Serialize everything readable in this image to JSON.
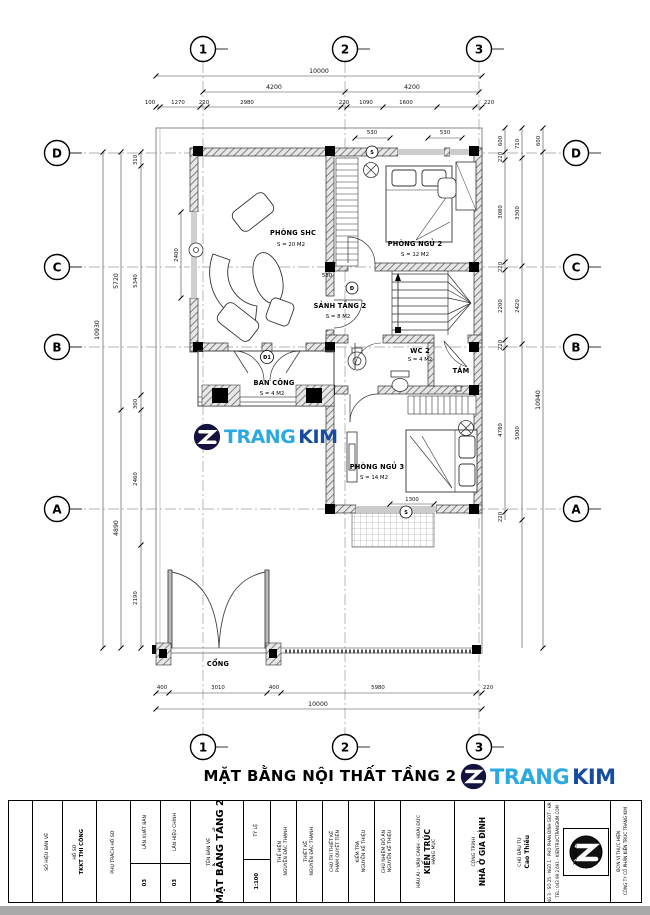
{
  "sheet": {
    "title": "MẶT BẰNG NỘI THẤT TẦNG 2"
  },
  "brand": {
    "trang": "TRANG",
    "kim": "KIM",
    "color_trang": "#2BA9E0",
    "color_kim": "#164BA0"
  },
  "grid": {
    "c1": "1",
    "c2": "2",
    "c3": "3",
    "rD": "D",
    "rC": "C",
    "rB": "B",
    "rA": "A"
  },
  "dims": {
    "t_overall": "10000",
    "t_span1": "4200",
    "t_span2": "4200",
    "t_d": [
      "100",
      "1270",
      "220",
      "2980",
      "220",
      "1090",
      "1600",
      "220"
    ],
    "t_small1": "530",
    "t_small2": "530",
    "b_d": [
      "400",
      "3010",
      "400",
      "5980",
      "220"
    ],
    "b_overall": "10000",
    "l_overall": "10930",
    "l_span1": "5720",
    "l_span2": "4890",
    "l_d": [
      "310",
      "5340",
      "300",
      "2460",
      "2190"
    ],
    "l_win": "2400",
    "r_d": [
      "600",
      "220",
      "3080",
      "220",
      "2200",
      "220",
      "4780",
      "220"
    ],
    "r_s": [
      "710",
      "3300",
      "2420",
      "5000"
    ],
    "r_top": "600",
    "r_overall": "10940",
    "i_door": "530",
    "i_bed": "1300"
  },
  "rooms": {
    "shc_name": "PHÒNG SHC",
    "shc_area": "S = 20 M2",
    "ngu2_name": "PHÒNG NGỦ 2",
    "ngu2_area": "S = 12 M2",
    "sanh_name": "SẢNH TẦNG 2",
    "sanh_area": "S = 8 M2",
    "wc2_name": "WC 2",
    "wc2_area": "S = 4 M2",
    "tam": "TẮM",
    "ngu3_name": "PHÒNG NGỦ 3",
    "ngu3_area": "S = 14 M2",
    "bc_name": "BAN CÔNG",
    "bc_area": "S = 4 M2",
    "cong": "CỔNG"
  },
  "tags": {
    "d1": "Đ1",
    "d": "Đ",
    "s1": "S",
    "s2": "S"
  },
  "titleblock": {
    "so_hieu_label": "SỐ HIỆU BẢN VẼ",
    "ho_so_label": "HỒ SƠ",
    "ho_so": "TKKT THI CÔNG",
    "phu_trach_label": "PHỤ TRÁCH HỒ SƠ",
    "lxb_label": "LẦN XUẤT BẢN",
    "lxb": "03",
    "lhc_label": "LẦN HIỆU CHỈNH",
    "lhc": "03",
    "tbv_label": "TÊN BẢN VẼ",
    "tbv": "MẶT BẰNG TẦNG 2",
    "tyle_label": "TỶ LỆ",
    "tyle": "1:100",
    "r1_label": "THỂ HIỆN",
    "r1": "NGUYỄN ĐẮC THẠNH",
    "r2_label": "THIẾT KẾ",
    "r2": "NGUYỄN ĐẮC THẠNH",
    "r3_label": "CHỦ TRÌ THIẾT KẾ",
    "r3": "PHẠM QUYẾT TIẾN",
    "r4_label": "KIỂM TRA",
    "r4": "NGUYỄN KẾ THIỆU",
    "r5_label": "CHỦ NHIỆM ĐỒ ÁN",
    "r5": "NGUYỄN KẾ THIỆU",
    "hm_label": "HẠNG MỤC",
    "hm": "KIẾN TRÚC",
    "dd": "HẬU ÁI - VÂN CANH - HOÀI ĐỨC",
    "ct_label": "CÔNG TRÌNH",
    "ct": "NHÀ Ở GIA ĐÌNH",
    "cdt_label": "CHỦ ĐẦU TƯ",
    "cdt": "Cao Thiều",
    "dvth_label": "ĐƠN VỊ THỰC HIỆN",
    "addr1": "CÔNG TY CỔ PHẦN KIẾN TRÚC TRANG KIM",
    "addr2": "TẦNG 3 - SỐ 25 - NGÕ 1 - PHỐ PHAN ĐÌNH GIÓT - HÀ NỘI",
    "addr3": "TEL: 043 99 2 691 - KIENTRUCTRANGKIM.COM",
    "logo_vert": "TRANGKIM"
  }
}
